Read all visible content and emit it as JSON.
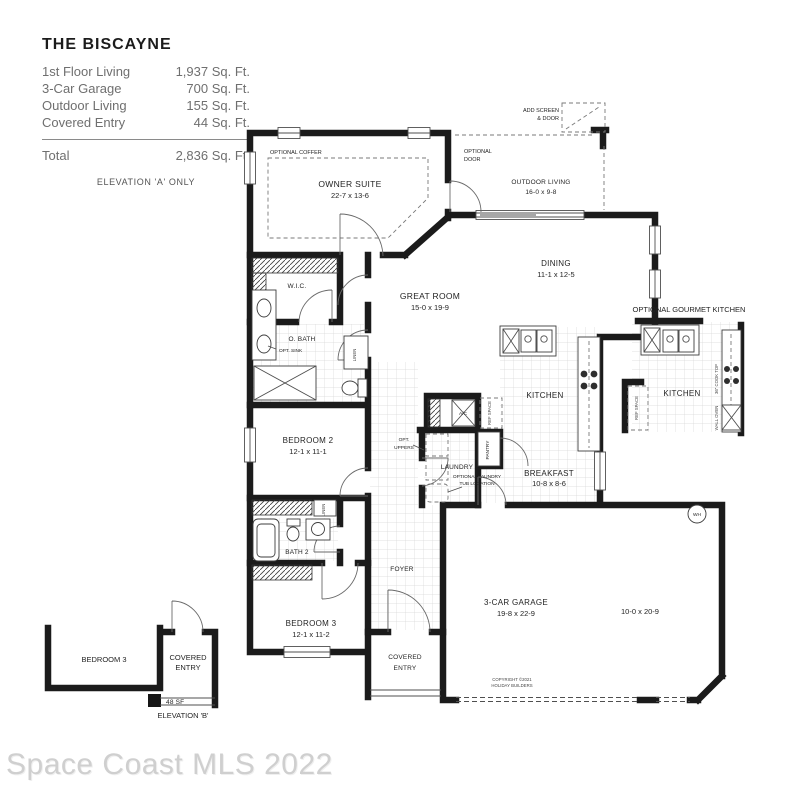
{
  "title_block": {
    "name": "THE BISCAYNE",
    "rows": [
      {
        "label": "1st Floor Living",
        "value": "1,937 Sq. Ft."
      },
      {
        "label": "3-Car Garage",
        "value": "700 Sq. Ft."
      },
      {
        "label": "Outdoor Living",
        "value": "155 Sq. Ft."
      },
      {
        "label": "Covered Entry",
        "value": "44 Sq. Ft."
      }
    ],
    "total": {
      "label": "Total",
      "value": "2,836 Sq. Ft."
    },
    "note": "ELEVATION 'A' ONLY"
  },
  "rooms": {
    "owner_suite": {
      "name": "OWNER SUITE",
      "dims": "22-7 x 13-6"
    },
    "outdoor_living": {
      "name": "OUTDOOR LIVING",
      "dims": "16-0 x 9-8"
    },
    "great_room": {
      "name": "GREAT ROOM",
      "dims": "15-0 x 19-9"
    },
    "dining": {
      "name": "DINING",
      "dims": "11-1 x 12-5"
    },
    "kitchen": {
      "name": "KITCHEN"
    },
    "breakfast": {
      "name": "BREAKFAST",
      "dims": "10-8 x 8-6"
    },
    "bedroom_2": {
      "name": "BEDROOM 2",
      "dims": "12-1 x 11-1"
    },
    "bedroom_3": {
      "name": "BEDROOM 3",
      "dims": "12-1 x 11-2"
    },
    "bath_2": {
      "name": "BATH 2"
    },
    "owner_bath": {
      "name": "O. BATH"
    },
    "wic": {
      "name": "W.I.C."
    },
    "laundry": {
      "name": "LAUNDRY"
    },
    "foyer": {
      "name": "FOYER"
    },
    "covered_entry": {
      "line1": "COVERED",
      "line2": "ENTRY"
    },
    "garage": {
      "name": "3-CAR GARAGE",
      "dims": "19-8 x 22-9",
      "bay_dims": "10-0 x 20-9"
    }
  },
  "annotations": {
    "optional_coffer": "OPTIONAL COFFER",
    "add_screen_line1": "ADD SCREEN",
    "add_screen_line2": "& DOOR",
    "optional_door_line1": "OPTIONAL",
    "optional_door_line2": "DOOR",
    "opt_sink": "OPT. SINK",
    "opt_uppers_line1": "OPT.",
    "opt_uppers_line2": "UPPERS",
    "laundry_tub_line1": "OPTIONAL LAUNDRY",
    "laundry_tub_line2": "TUB LOCATION",
    "pantry": "PANTRY",
    "linen": "LINEN",
    "ref_space": "REF SPACE",
    "cook_top": "36\" COOK TOP",
    "wall_oven": "WALL OVEN",
    "ac_unit": "A/C",
    "water_heater": "WH",
    "gourmet_title": "OPTIONAL GOURMET KITCHEN",
    "gourmet_kitchen": "KITCHEN",
    "copyright_line1": "COPYRIGHT ©2021",
    "copyright_line2": "HOLIDAY BUILDERS"
  },
  "elevation_b": {
    "bedroom_3": "BEDROOM 3",
    "covered_line1": "COVERED",
    "covered_line2": "ENTRY",
    "area": "48 SF",
    "label": "ELEVATION 'B'"
  },
  "watermark": "Space Coast MLS 2022"
}
